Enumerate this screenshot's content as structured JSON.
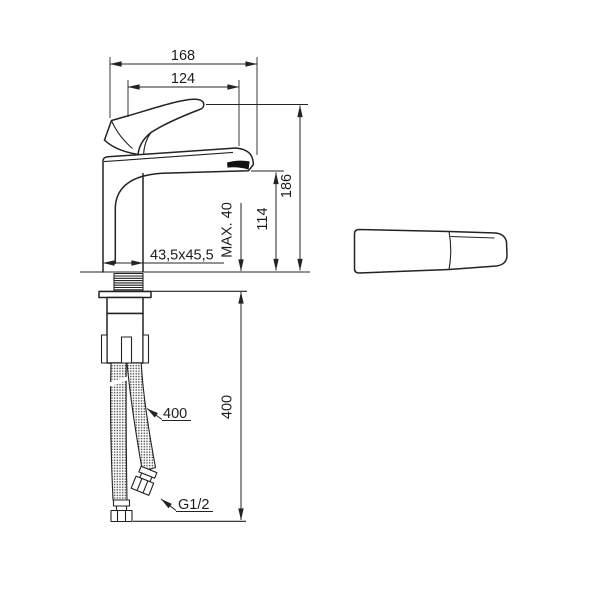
{
  "drawing": {
    "type": "faucet-installation-dimensions",
    "dims": {
      "total_width": "168",
      "spout_reach": "124",
      "total_height": "186",
      "outlet_height": "114",
      "max_deck_thickness": "MAX. 40",
      "base_cross_section": "43,5x45,5",
      "hose_length_dim": "400",
      "hose_length_label": "400",
      "thread_size": "G1/2"
    },
    "colors": {
      "line": "#232323",
      "background": "#ffffff"
    }
  }
}
